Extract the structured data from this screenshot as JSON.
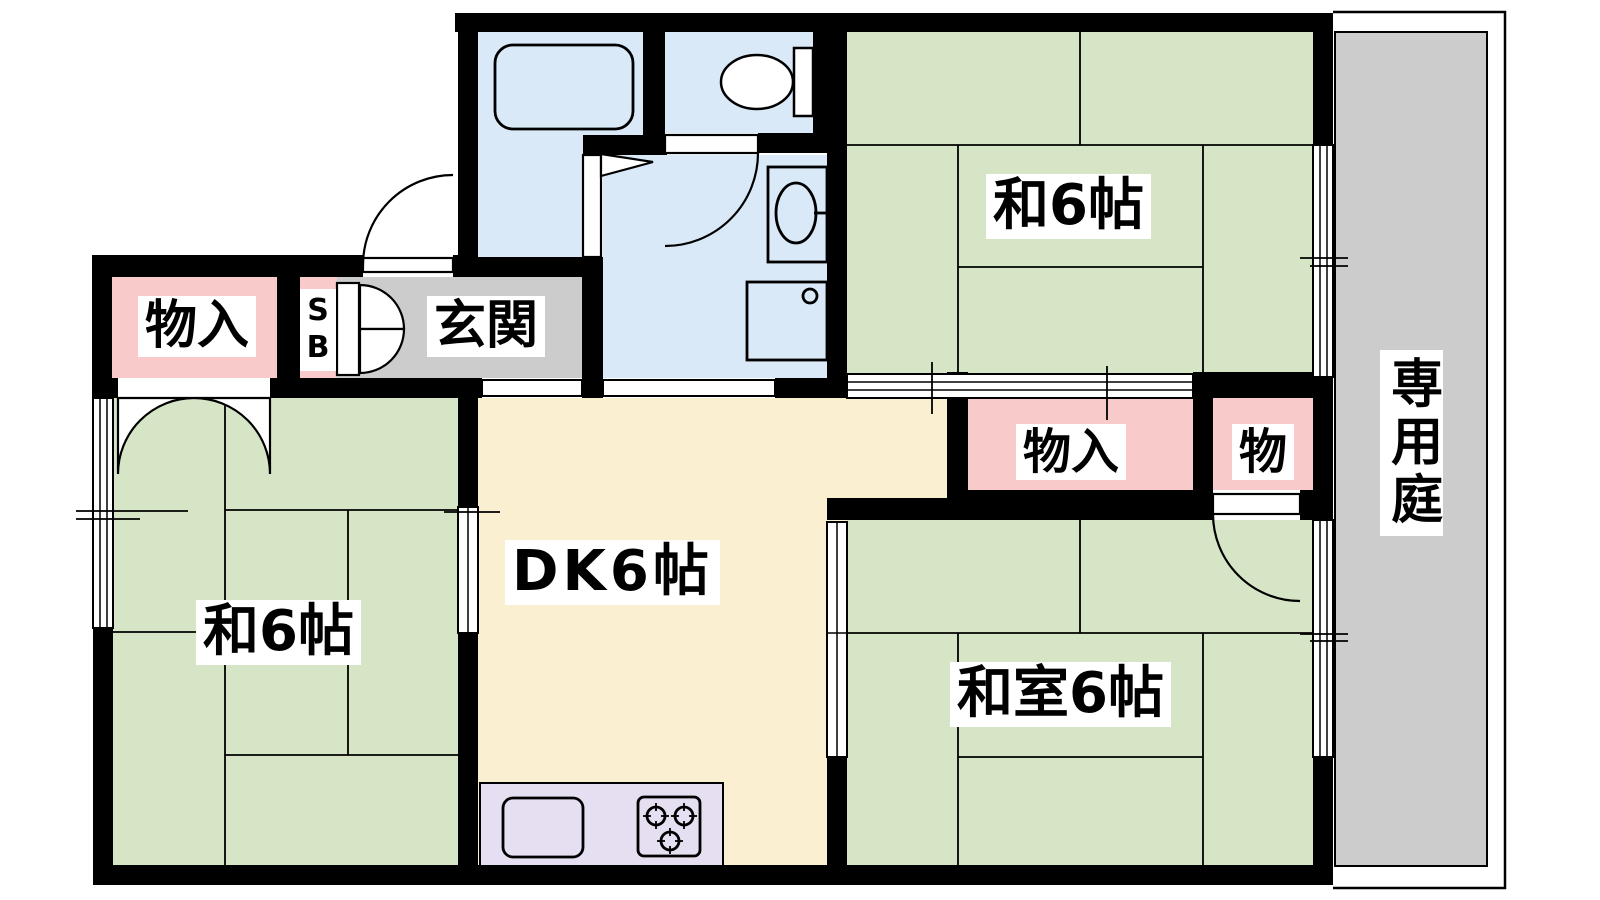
{
  "colors": {
    "tatami": "#d5e5c6",
    "dk": "#fbefd1",
    "closet": "#f8caca",
    "wet": "#dae9f8",
    "counter": "#e6def1",
    "hall": "#cccccc",
    "garden": "#cccccc",
    "wall": "#000000"
  },
  "rooms": {
    "closet_left": {
      "label": "物入"
    },
    "shoe_box": {
      "label": "SB"
    },
    "entrance": {
      "label": "玄関"
    },
    "japanese_room_top": {
      "label": "和6帖"
    },
    "closet_right": {
      "label": "物入"
    },
    "closet_small": {
      "label": "物"
    },
    "dining_kitchen": {
      "label": "DK6帖"
    },
    "japanese_room_left": {
      "label": "和6帖"
    },
    "japanese_room_bottom": {
      "label": "和室6帖"
    },
    "private_garden": {
      "label": "専用庭"
    }
  }
}
